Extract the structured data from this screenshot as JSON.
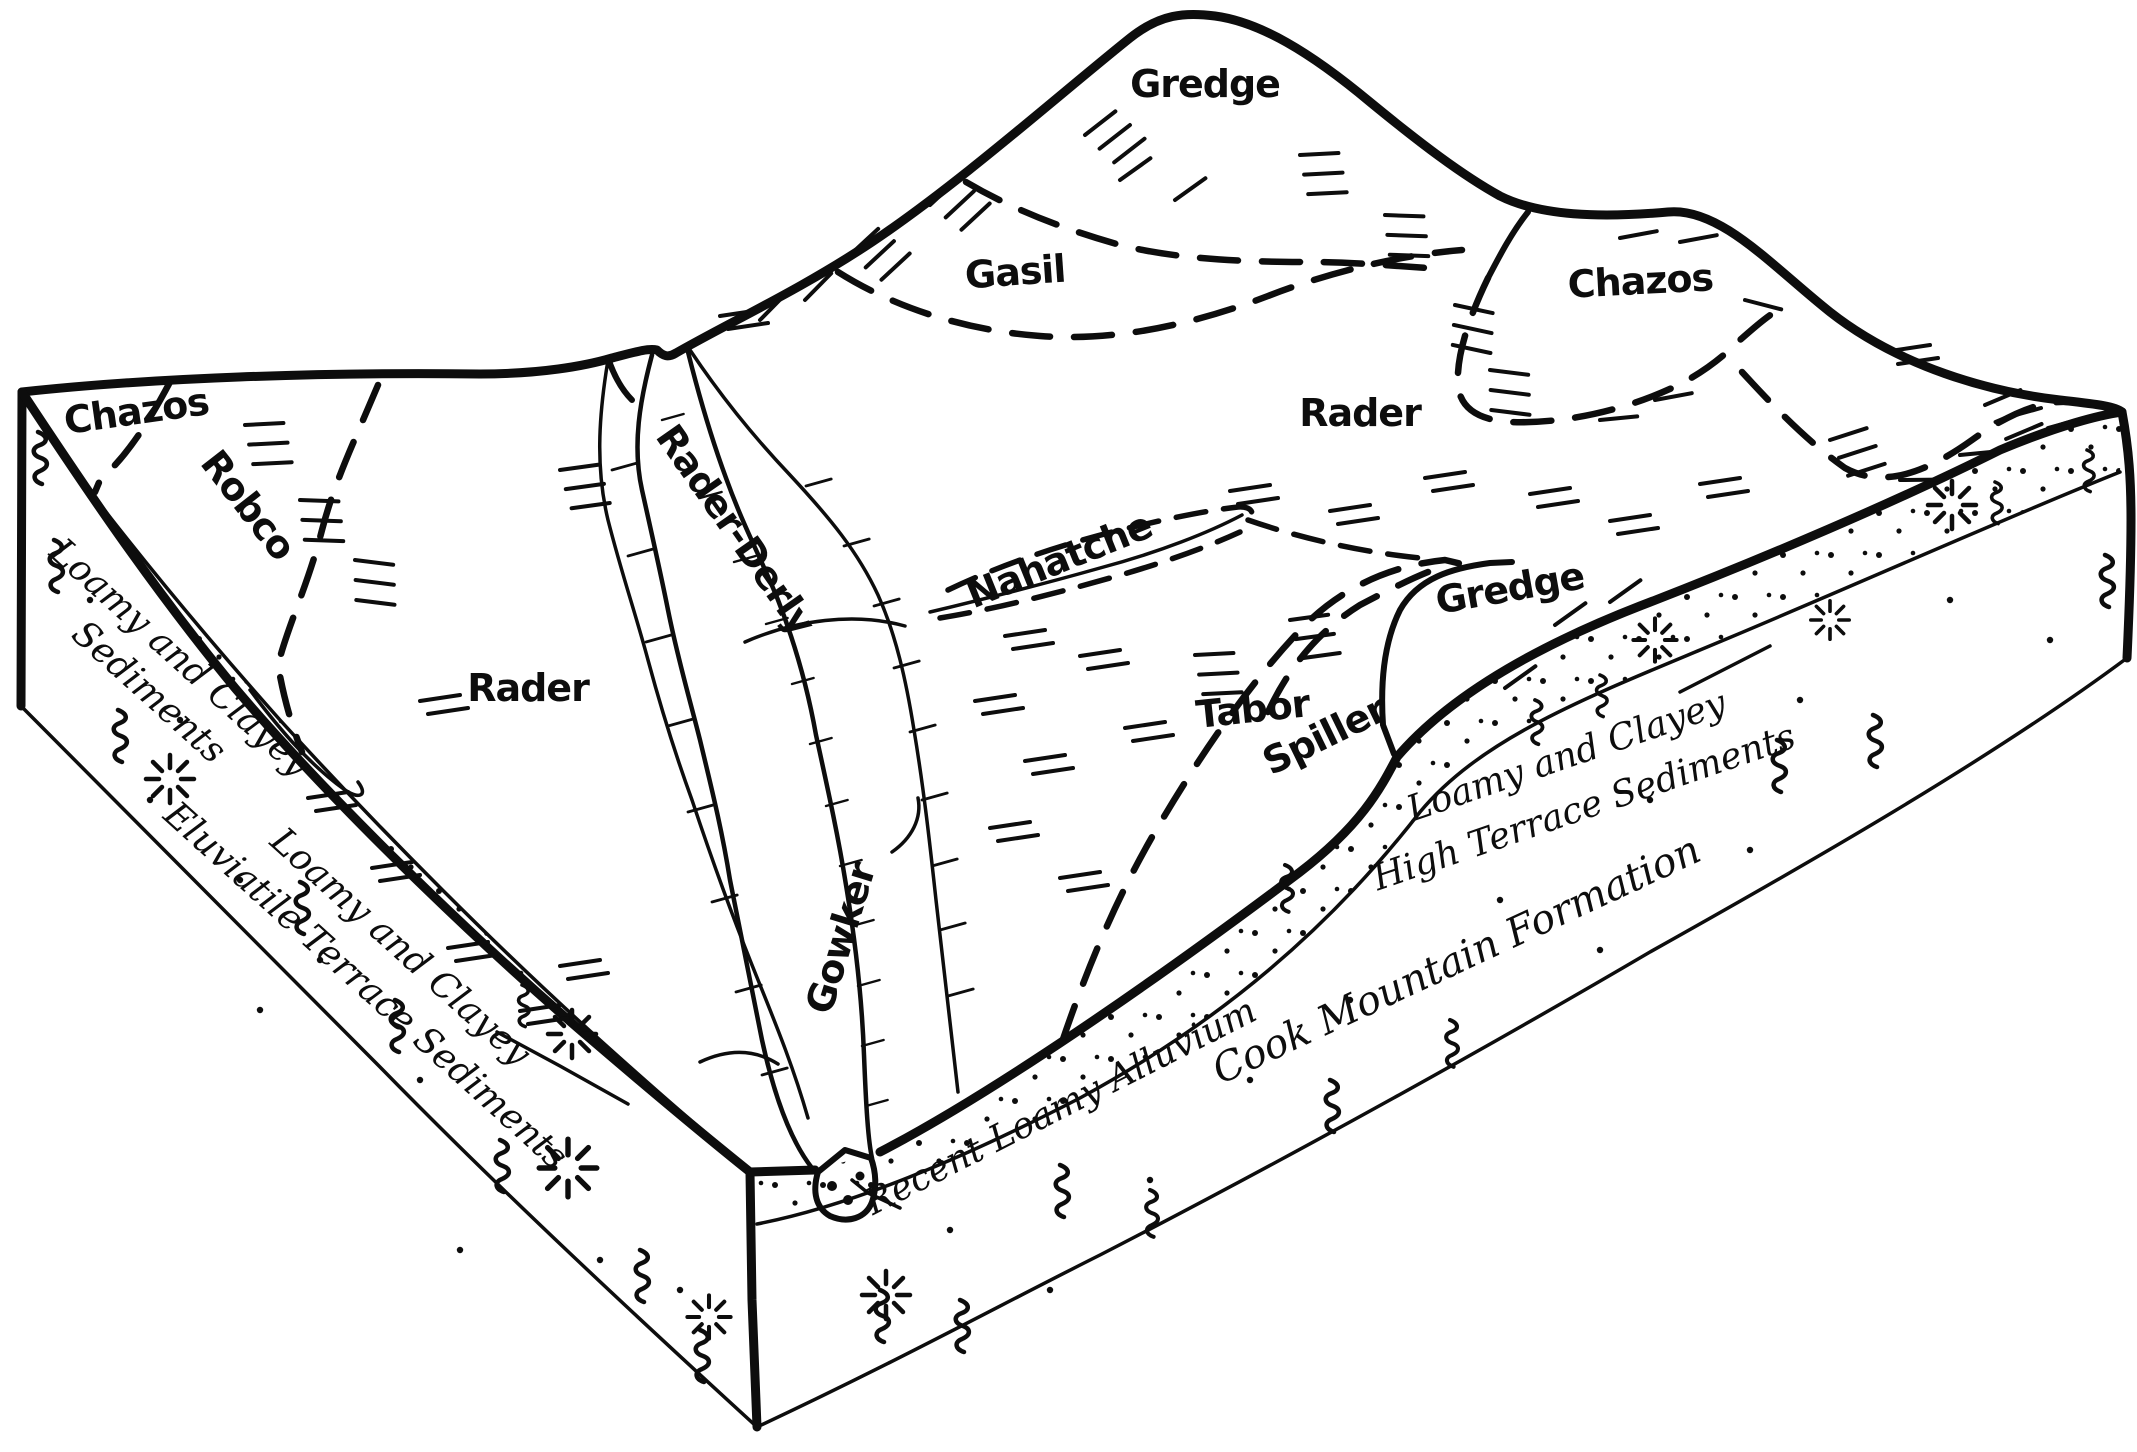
{
  "figure": {
    "type": "soil-block-diagram",
    "colors": {
      "ink": "#0d0d0d",
      "background": "#ffffff"
    },
    "surface_units": {
      "gredge_hill": "Gredge",
      "gasil": "Gasil",
      "chazos_east": "Chazos",
      "rader_east": "Rader",
      "chazos_west": "Chazos",
      "robco": "Robco",
      "rader_west": "Rader",
      "rader_derly": "Rader-Derly",
      "nahatche": "Nahatche",
      "gredge_terrace": "Gredge",
      "tabor": "Tabor",
      "spiller": "Spiller",
      "gowker": "Gowker"
    },
    "subsurface_units": {
      "loamy_clayey_sediments": {
        "line1": "Loamy and Clayey",
        "line2": "Sediments"
      },
      "eluviatile_terrace": {
        "line1": "Loamy and Clayey",
        "line2": "Eluviatile Terrace Sediments"
      },
      "high_terrace": {
        "line1": "Loamy and Clayey",
        "line2": "High Terrace Sediments"
      },
      "recent_alluvium": "Recent Loamy Alluvium",
      "cook_mountain": "Cook Mountain Formation"
    }
  }
}
